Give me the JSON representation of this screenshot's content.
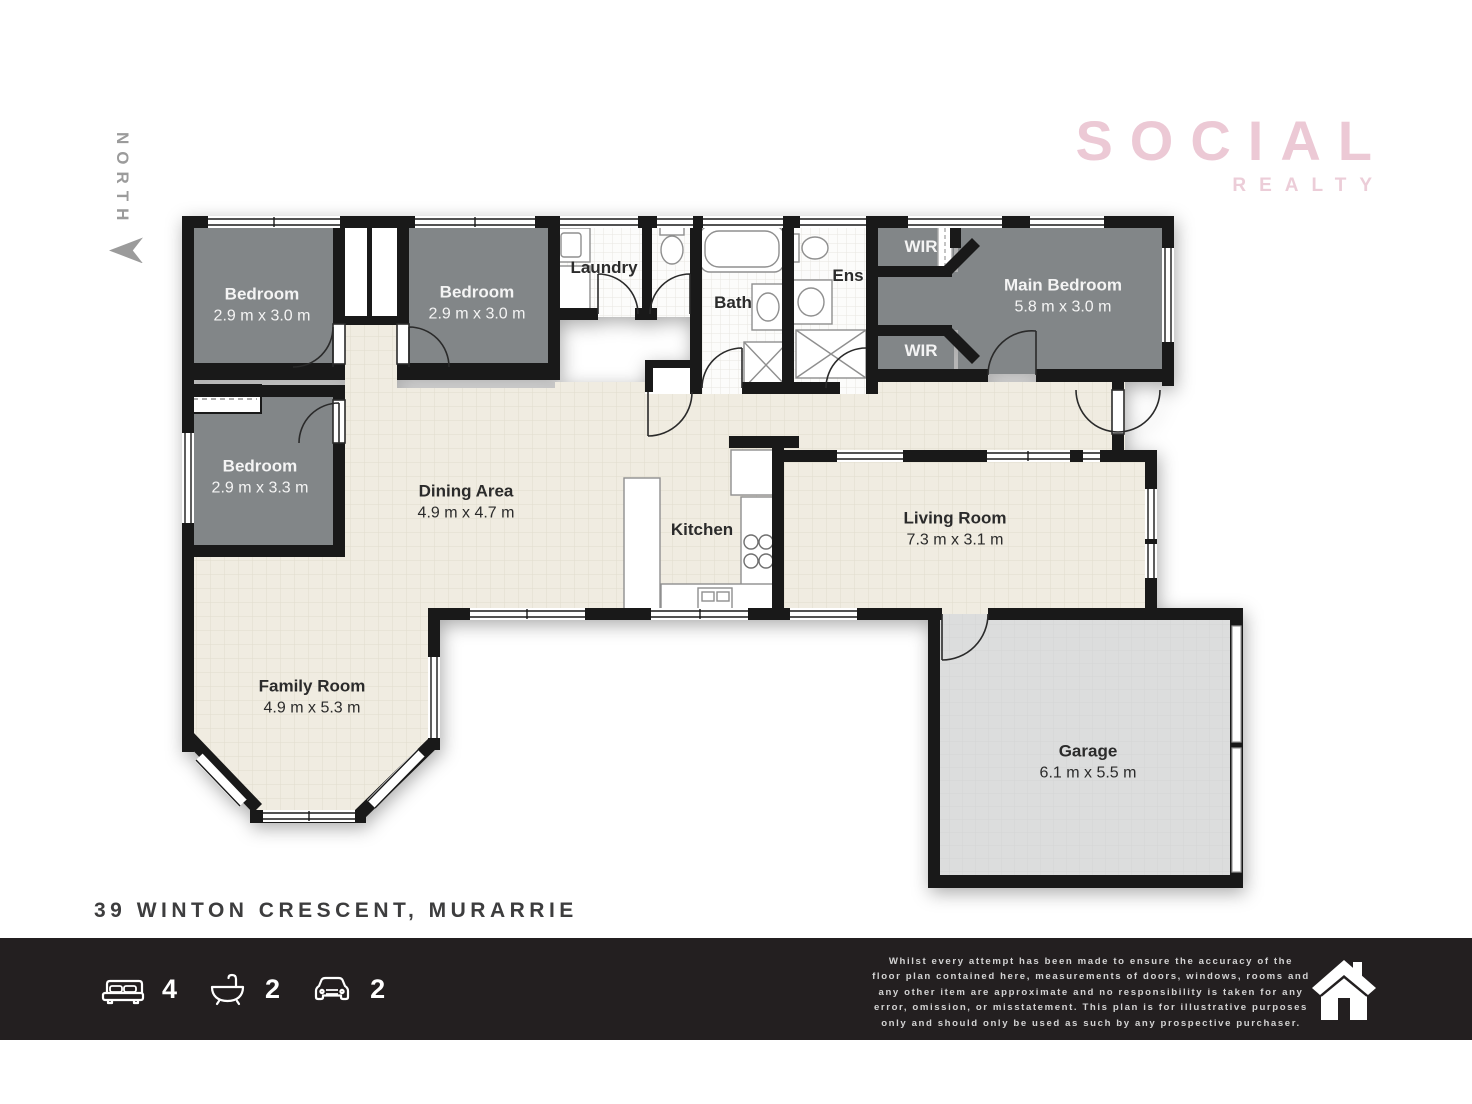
{
  "north": {
    "label": "NORTH"
  },
  "logo": {
    "title": "SOCIAL",
    "subtitle": "REALTY",
    "color": "#ecc9d5",
    "subtitle_color": "#eccdd8"
  },
  "address": "39 WINTON CRESCENT, MURARRIE",
  "rooms": [
    {
      "name": "Bedroom",
      "dims": "2.9 m x 3.0 m",
      "x": 262,
      "y": 305,
      "theme": "light"
    },
    {
      "name": "Bedroom",
      "dims": "2.9 m x 3.0 m",
      "x": 477,
      "y": 303,
      "theme": "light"
    },
    {
      "name": "Laundry",
      "dims": "",
      "x": 604,
      "y": 268,
      "theme": "dark"
    },
    {
      "name": "Bath",
      "dims": "",
      "x": 733,
      "y": 303,
      "theme": "dark"
    },
    {
      "name": "Ens",
      "dims": "",
      "x": 848,
      "y": 276,
      "theme": "dark"
    },
    {
      "name": "WIR",
      "dims": "",
      "x": 921,
      "y": 247,
      "theme": "light"
    },
    {
      "name": "WIR",
      "dims": "",
      "x": 921,
      "y": 351,
      "theme": "light"
    },
    {
      "name": "Main Bedroom",
      "dims": "5.8 m x 3.0 m",
      "x": 1063,
      "y": 296,
      "theme": "light"
    },
    {
      "name": "Bedroom",
      "dims": "2.9 m x 3.3 m",
      "x": 260,
      "y": 477,
      "theme": "light"
    },
    {
      "name": "Dining Area",
      "dims": "4.9 m x 4.7 m",
      "x": 466,
      "y": 502,
      "theme": "dark"
    },
    {
      "name": "Kitchen",
      "dims": "",
      "x": 702,
      "y": 530,
      "theme": "dark"
    },
    {
      "name": "Living Room",
      "dims": "7.3 m x 3.1 m",
      "x": 955,
      "y": 529,
      "theme": "dark"
    },
    {
      "name": "Family Room",
      "dims": "4.9 m x 5.3 m",
      "x": 312,
      "y": 697,
      "theme": "dark"
    },
    {
      "name": "Garage",
      "dims": "6.1 m x 5.5 m",
      "x": 1088,
      "y": 762,
      "theme": "dark"
    }
  ],
  "footer": {
    "stats": [
      {
        "icon": "bed-icon",
        "value": "4"
      },
      {
        "icon": "bath-icon",
        "value": "2"
      },
      {
        "icon": "car-icon",
        "value": "2"
      }
    ],
    "disclaimer_lines": [
      "Whilst every attempt has been made to ensure the accuracy of the",
      "floor plan contained here, measurements of doors, windows, rooms and",
      "any other item are approximate and no responsibility is taken for any",
      "error, omission, or misstatement. This plan is for illustrative purposes",
      "only and should only be used as such by any prospective purchaser."
    ]
  },
  "colors": {
    "wall": "#191919",
    "bedroom_fill": "#828688",
    "living_fill": "#f0ece1",
    "tile_fill": "#fcfcfb",
    "garage_fill": "#dcdddd",
    "footer_bg": "#231f20",
    "logo_pink": "#ecc9d5",
    "north_gray": "#9b9b9b"
  }
}
